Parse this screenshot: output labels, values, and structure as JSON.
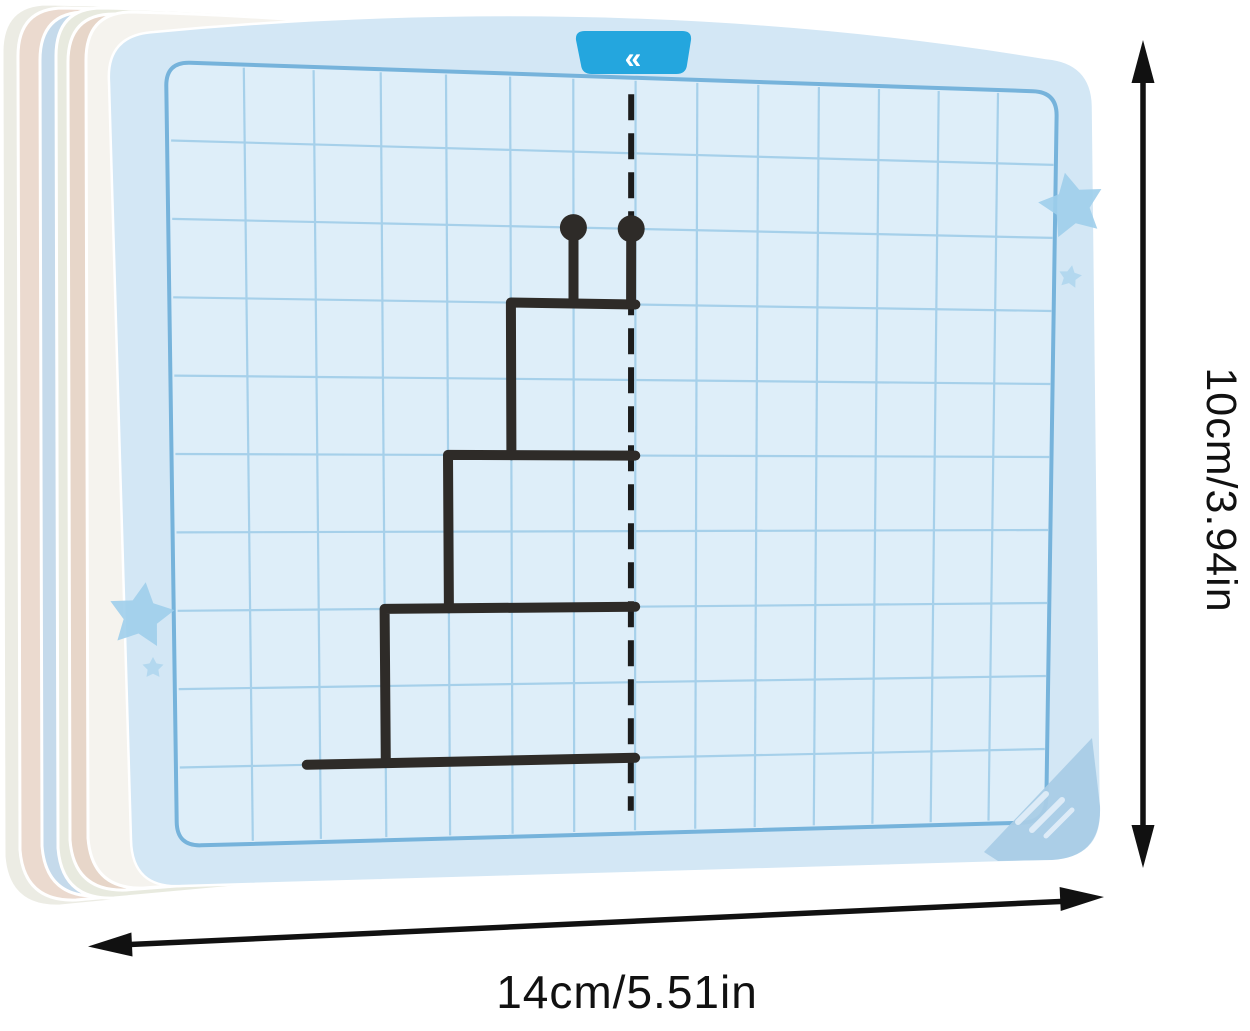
{
  "scene": {
    "description": "Stack of dry-erase symmetry practice drawing cards with measurement arrows",
    "tab": {
      "glyph": "«"
    }
  },
  "dimensions": {
    "height_label": "10cm/3.94in",
    "width_label": "14cm/5.51in"
  },
  "grid": {
    "columns": 14,
    "rows": 10
  },
  "figure": {
    "name": "half-cake-with-candles-to-mirror",
    "stroke_width": 10,
    "dot_radius": 13.5,
    "mirror": {
      "col": 6.93,
      "from_row": 0.22,
      "to_row": 9.7
    },
    "dots": [
      [
        6,
        2
      ],
      [
        6.93,
        2
      ]
    ],
    "stems": [
      [
        [
          6,
          2.17
        ],
        [
          6,
          3
        ]
      ],
      [
        [
          6.93,
          2.17
        ],
        [
          6.93,
          3
        ]
      ]
    ],
    "steps": [
      [
        [
          7,
          3
        ],
        [
          5,
          3
        ],
        [
          5,
          5
        ]
      ],
      [
        [
          7,
          5
        ],
        [
          4,
          5
        ],
        [
          4,
          7
        ]
      ],
      [
        [
          7,
          7
        ],
        [
          3,
          7
        ],
        [
          3,
          9
        ]
      ]
    ],
    "base": [
      [
        1.8,
        9
      ],
      [
        7,
        9
      ]
    ]
  },
  "colors": {
    "tab": "#24A6DE",
    "card_face": "#D3E7F5",
    "grid_fill": "#DEEEF9",
    "grid_line": "#A6D0EA",
    "grid_border": "#76B3DB",
    "figure_stroke": "#2E2B28",
    "mirror_line": "#1C1C1C",
    "arrow": "#111111",
    "text": "#111111",
    "star": "#9FCEEB",
    "corner": "#A9CCE6",
    "stack": [
      "#ECECE4",
      "#EBDACF",
      "#C5DAEB",
      "#E8EADF",
      "#E7D6C9",
      "#F5F3EE"
    ]
  }
}
